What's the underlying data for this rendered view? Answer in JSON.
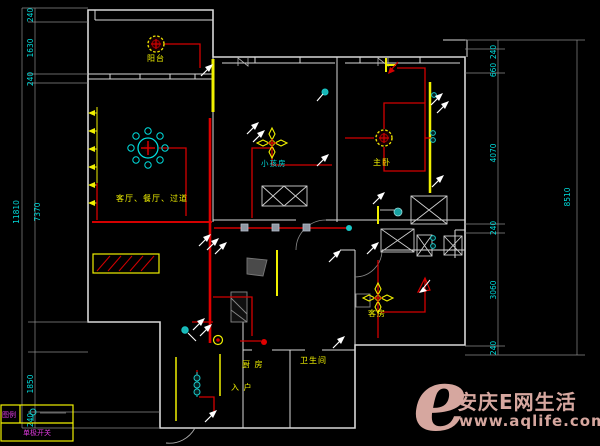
{
  "colors": {
    "wire_red": "#d40000",
    "wall_yellow": "#f0f000",
    "dim_cyan": "#00dcdc",
    "legend_magenta": "#e03ae0",
    "watermark_pink": "#d6a79f",
    "background": "#000000"
  },
  "rooms": {
    "balcony": "阳台",
    "living": "客厅、餐厅、过道",
    "kids": "小孩房",
    "master": "主卧",
    "guest": "客房",
    "kitchen": "厨 房",
    "bath": "卫生间",
    "entry": "入 户"
  },
  "dims": {
    "left": {
      "s1": "240",
      "s2": "1630",
      "s3": "240",
      "inner": "7370",
      "s4": "1850",
      "s5": "240",
      "total": "11810"
    },
    "right": {
      "s1": "240",
      "s2": "660",
      "s3": "4070",
      "s4": "240",
      "s5": "3060",
      "s6": "240",
      "total": "8510"
    }
  },
  "legend": {
    "header": "图例",
    "switch_label": "单极开关"
  },
  "watermark": {
    "logo": "e",
    "title": "安庆E网生活",
    "url": "www.aqlife.com"
  }
}
